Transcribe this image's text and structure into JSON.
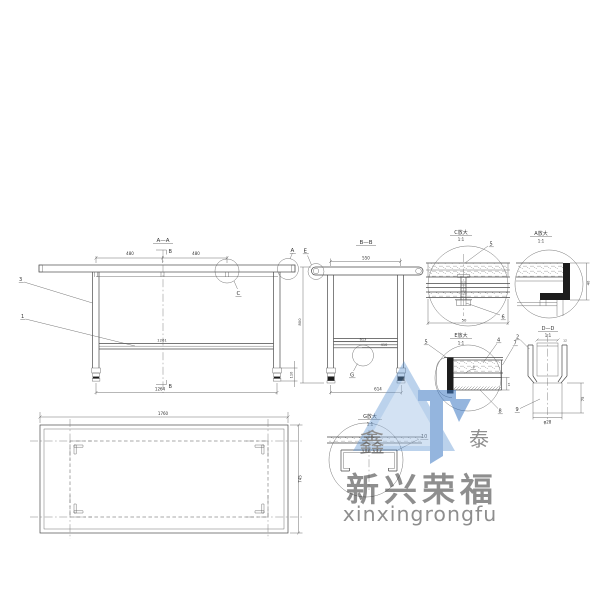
{
  "drawing": {
    "bg": "#ffffff",
    "line": "#4a4a4a"
  },
  "front_view": {
    "title": "A—A",
    "section_top": "B",
    "section_bottom": "B",
    "dim_left": "480",
    "dim_right": "480",
    "dim_shelf": "1261",
    "dim_bottom": "1264",
    "dim_foot": "110",
    "label_c": "C",
    "label_a": "A",
    "part_1": "1",
    "part_3": "3"
  },
  "side_view": {
    "title": "B—B",
    "dim_top": "550",
    "dim_height": "800",
    "dim_shelf": "613",
    "dim_shelf_2": "410",
    "dim_bottom": "614",
    "label_e": "E",
    "label_g": "G"
  },
  "plan_view": {
    "dim_length": "1760",
    "dim_depth": "745"
  },
  "detail_c": {
    "title": "C放大",
    "scale": "1:1",
    "dim_width": "50",
    "part_5": "5",
    "part_6": "6"
  },
  "detail_a": {
    "title": "A放大",
    "scale": "1:1",
    "dim_edge": "40"
  },
  "detail_e": {
    "title": "E放大",
    "scale": "1:1",
    "dim_thickness": "15",
    "part_4": "4",
    "part_5": "5",
    "part_7": "7",
    "part_8": "8",
    "weld_mark": "4"
  },
  "detail_d": {
    "title": "D—D",
    "scale": "1:1",
    "dim_rod": "12",
    "dim_height": "75",
    "dim_dia": "φ28",
    "part_2": "2",
    "part_9": "9"
  },
  "detail_g": {
    "title": "G放大",
    "scale": "1:1",
    "part_10": "10"
  },
  "watermark": {
    "seal_char": "鑫",
    "tai_char": "泰",
    "brand_cn": "新兴荣福",
    "brand_en": "xinxingrongfu",
    "blue": "#3d79c4",
    "gold": "#d4a527"
  }
}
